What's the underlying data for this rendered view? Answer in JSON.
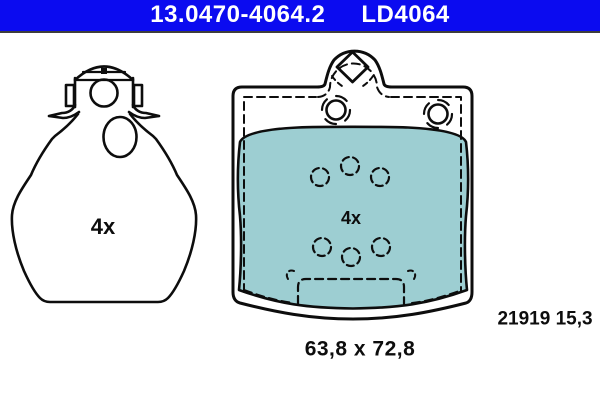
{
  "header": {
    "catalog_number": "13.0470-4064.2",
    "box_code": "LD4064"
  },
  "left_drawing": {
    "quantity": "4x"
  },
  "right_drawing": {
    "quantity": "4x"
  },
  "footer": {
    "pad_dimensions": "63,8 x 72,8",
    "wva_thickness": "21919 15,3"
  },
  "colors": {
    "header_bar": "#0b0bf0",
    "friction_material": "#9dced2",
    "line": "#0d0d0d"
  }
}
